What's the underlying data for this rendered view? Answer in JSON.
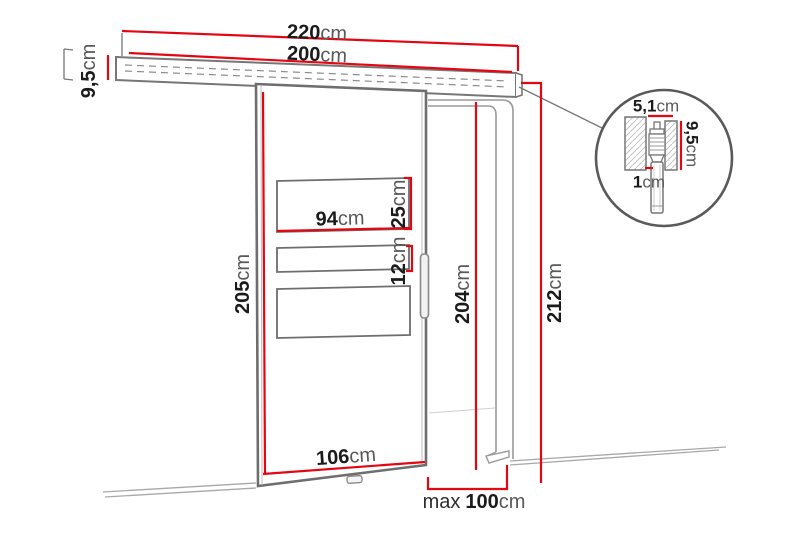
{
  "diagram_title": "sliding-door-dimension-diagram",
  "colors": {
    "dimension_red": "#e30613",
    "outline_gray": "#6e6e6e",
    "frame_gray": "#9a9a9a",
    "text_black": "#1b1b1b",
    "unit_gray": "#595959"
  },
  "dims": {
    "track_total": {
      "value": "220",
      "unit": "cm"
    },
    "rail_length": {
      "value": "200",
      "unit": "cm"
    },
    "rail_height": {
      "value": "9,5",
      "unit": "cm"
    },
    "door_height": {
      "value": "205",
      "unit": "cm"
    },
    "glass_width": {
      "value": "94",
      "unit": "cm"
    },
    "glass_top_height": {
      "value": "25",
      "unit": "cm"
    },
    "glass_mid_height": {
      "value": "12",
      "unit": "cm"
    },
    "opening_height": {
      "value": "204",
      "unit": "cm"
    },
    "overall_height": {
      "value": "212",
      "unit": "cm"
    },
    "door_width": {
      "value": "106",
      "unit": "cm"
    },
    "max_width": {
      "prefix": "max",
      "value": "100",
      "unit": "cm"
    },
    "detail_width": {
      "value": "5,1",
      "unit": "cm"
    },
    "detail_height": {
      "value": "9,5",
      "unit": "cm"
    },
    "detail_gap": {
      "value": "1",
      "unit": "cm"
    }
  }
}
